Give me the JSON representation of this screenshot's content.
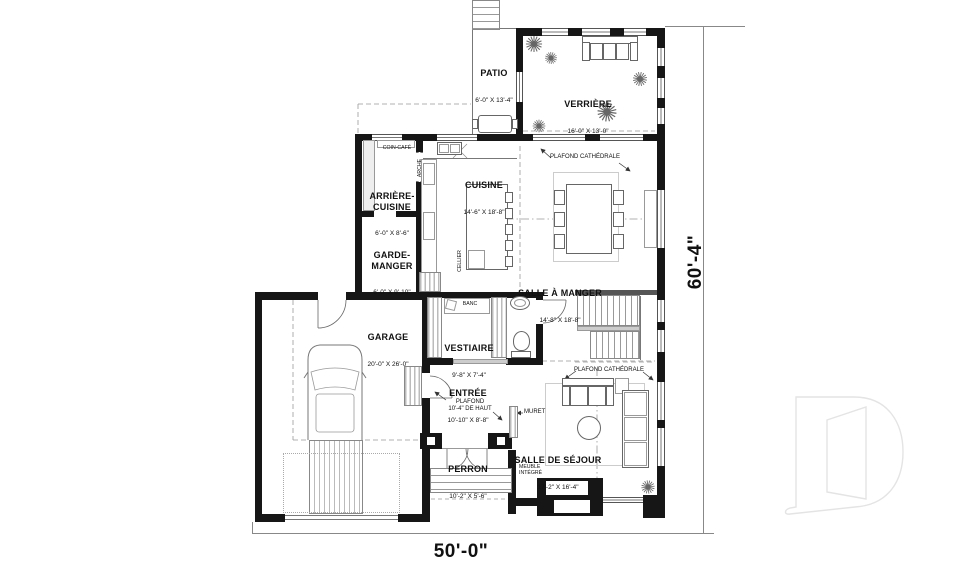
{
  "rooms": {
    "patio": {
      "name": "PATIO",
      "dims": "6'-0\" X 13'-4\""
    },
    "verriere": {
      "name": "VERRIÈRE",
      "dims": "16'-0\" X 13'-0\""
    },
    "cuisine": {
      "name": "CUISINE",
      "dims": "14'-6\" X 18'-8\""
    },
    "arriere_cuisine": {
      "name": "ARRIÈRE-\nCUISINE",
      "dims": "6'-0\" X 8'-6\""
    },
    "garde_manger": {
      "name": "GARDE-\nMANGER",
      "dims": "6'-0\" X 9'-10\""
    },
    "salle_a_manger": {
      "name": "SALLE À MANGER",
      "dims": "14'-8\" X 18'-8\""
    },
    "garage": {
      "name": "GARAGE",
      "dims": "20'-0\" X 26'-0\""
    },
    "vestiaire": {
      "name": "VESTIAIRE",
      "dims": "9'-8\" X 7'-4\""
    },
    "entree": {
      "name": "ENTRÉE",
      "dims": "10'-10\" X 8'-8\""
    },
    "perron": {
      "name": "PERRON",
      "dims": "10'-2\" X 5'-6\""
    },
    "sejour": {
      "name": "SALLE DE SÉJOUR",
      "dims": "17'-2\" X 16'-4\""
    }
  },
  "annotations": {
    "coin_cafe": "COIN-CAFÉ",
    "arche": "ARCHE",
    "cellier": "CELLIER",
    "banc": "BANC",
    "plafond_cathedrale_dining": "PLAFOND CATHÉDRALE",
    "plafond_cathedrale_sejour": "PLAFOND CATHÉDRALE",
    "plafond_entree": "PLAFOND\n10'-4\" DE HAUT",
    "muret": "MURET",
    "meuble_integre": "MEUBLE\nINTÉGRÉ"
  },
  "dimensions": {
    "overall_width": "50'-0\"",
    "overall_height": "60'-4\""
  },
  "watermark": {
    "shape": "D"
  },
  "colors": {
    "wall": "#161616",
    "line_dark": "#555555",
    "line_light": "#aaaaaa",
    "hatch": "#c9c9c9",
    "watermark": "#e4e4e4",
    "background": "#ffffff"
  }
}
